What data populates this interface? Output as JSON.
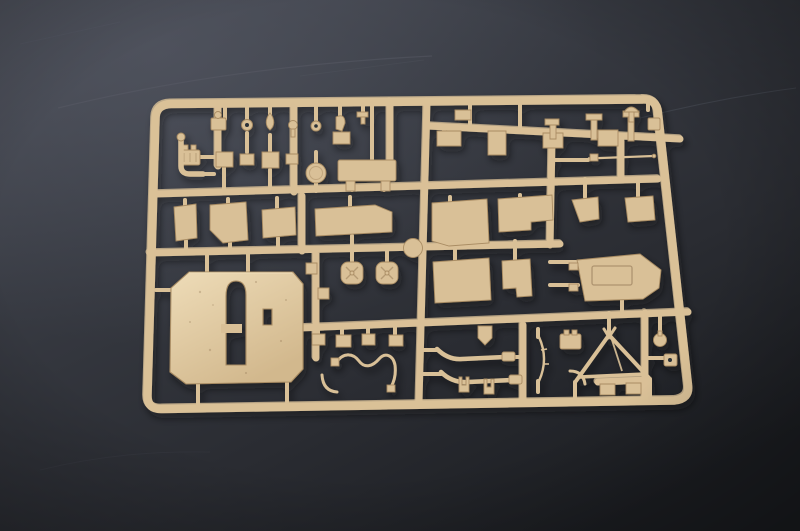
{
  "scene": {
    "type": "photograph",
    "description": "Overhead photograph of a tan injection-moulded plastic model-kit sprue (parts tree) full of unassembled parts, lying at a slight angle on a dark charcoal surface with faint scratches",
    "subject": "model kit sprue",
    "notable_parts": [
      "large superstructure panel with arched vertical slot and small rectangular opening",
      "two round hatches with cross ribbing",
      "angled hull plate with rectangular recess",
      "A-frame tow bar",
      "curved tow-cable and pipe rods",
      "thin antenna rod",
      "round disc",
      "rows of small plates, brackets, periscopes and fittings"
    ],
    "background": "dark charcoal surface, lighter at upper left, with faint diagonal scratches"
  },
  "colors": {
    "plastic": "#d9c097",
    "plastic_light": "#eedcb8",
    "plastic_shadow": "#a98c63",
    "plastic_deep": "#8a6f4e",
    "slot": "#2c3037",
    "surface_top": "#4a4d57",
    "surface_upper": "#383b43",
    "surface_mid": "#2a2c32",
    "surface_dark": "#1b1d21",
    "scratch": "#5a5e69"
  }
}
